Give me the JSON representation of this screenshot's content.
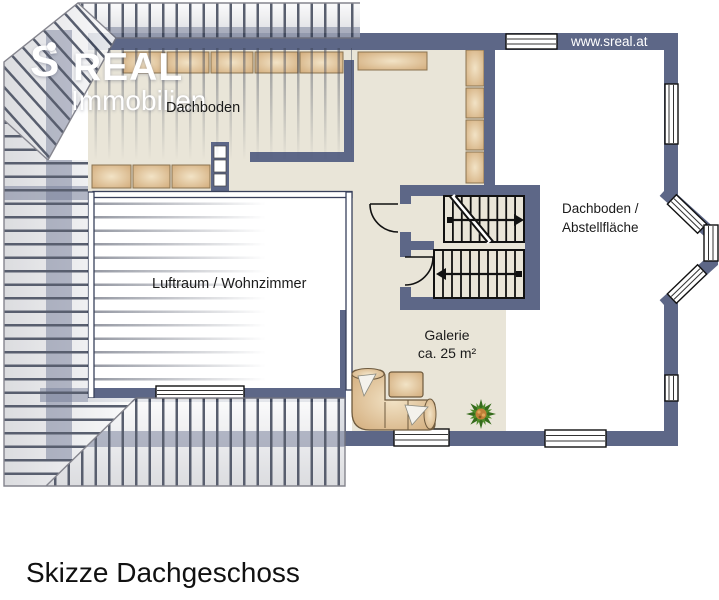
{
  "logo": {
    "s_letter": "S",
    "brand": "REAL",
    "subtitle": "Immobilien"
  },
  "header": {
    "website": "www.sreal.at"
  },
  "rooms": {
    "dachboden": "Dachboden",
    "luftraum_wohnzimmer": "Luftraum / Wohnzimmer",
    "abstell_line1": "Dachboden /",
    "abstell_line2": "Abstellfläche",
    "galerie_line1": "Galerie",
    "galerie_line2": "ca. 25 m²"
  },
  "caption": "Skizze Dachgeschoss",
  "colors": {
    "wall": "#5d6787",
    "wallDark": "#39415c",
    "floor": "#e9e5d8",
    "hatch": "#3f4658",
    "cabinet_light": "#f2e3c6",
    "cabinet_dark": "#d0a876",
    "cabinet_border": "#8a7350",
    "sofa_line": "#6e5a3e",
    "stair": "#111111",
    "text": "#1b1b1b",
    "logo": "#ffffff",
    "plant_green": "#4c8a28",
    "plant_dark": "#356b1c",
    "plant_center": "#c08038",
    "roof_light": "#fbfbfc",
    "roof_dark": "#d6d7db",
    "outline": "#73737d"
  }
}
